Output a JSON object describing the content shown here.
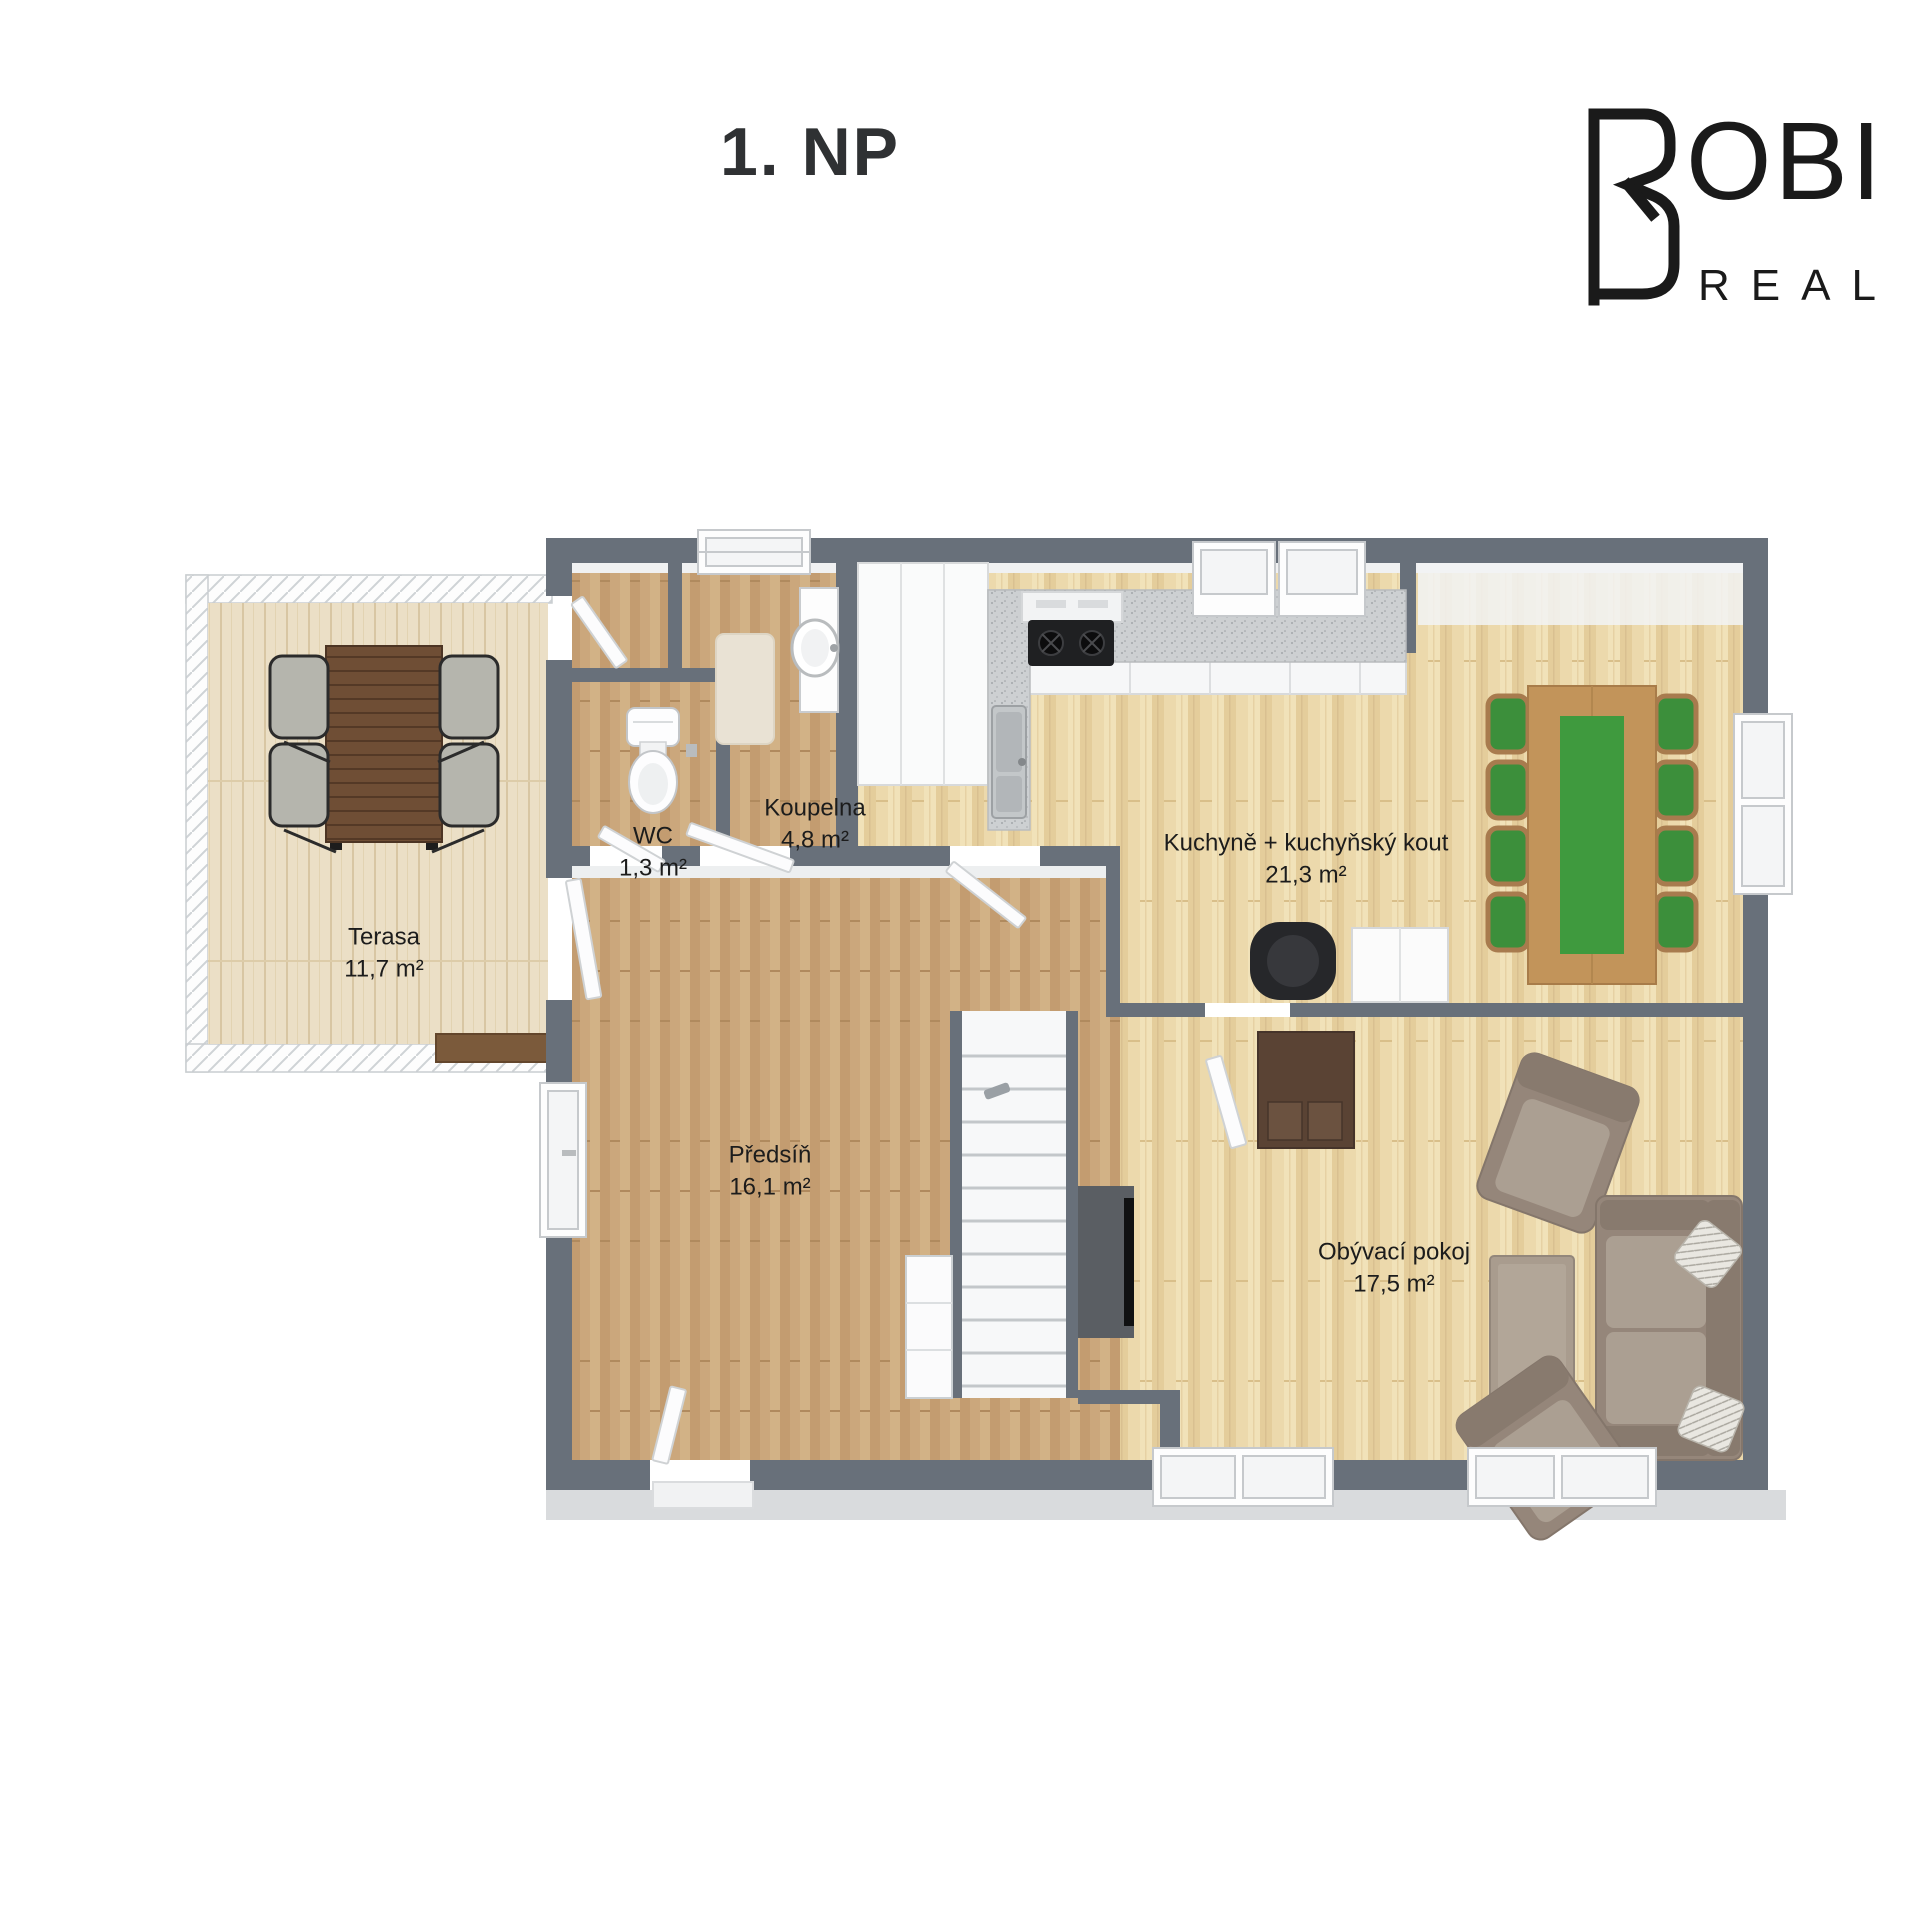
{
  "page": {
    "title": "1. NP",
    "background": "#ffffff"
  },
  "brand": {
    "name": "ROBI REAL",
    "mark": "stylized-RB-monogram",
    "top_text": "OBI",
    "bottom_text": "REAL",
    "color": "#1a1a1a"
  },
  "rooms": [
    {
      "id": "terasa",
      "name": "Terasa",
      "area": "11,7 m²",
      "label_x": 384,
      "label_y": 953
    },
    {
      "id": "wc",
      "name": "WC",
      "area": "1,3 m²",
      "label_x": 653,
      "label_y": 852
    },
    {
      "id": "koupelna",
      "name": "Koupelna",
      "area": "4,8 m²",
      "label_x": 815,
      "label_y": 824
    },
    {
      "id": "kuchyne",
      "name": "Kuchyně + kuchyňský kout",
      "area": "21,3 m²",
      "label_x": 1306,
      "label_y": 859
    },
    {
      "id": "predsin",
      "name": "Předsíň",
      "area": "16,1 m²",
      "label_x": 770,
      "label_y": 1171
    },
    {
      "id": "obyvaci",
      "name": "Obývací pokoj",
      "area": "17,5 m²",
      "label_x": 1394,
      "label_y": 1268
    }
  ],
  "colors": {
    "wall": "#68707a",
    "floor_light_wood": "#ecd9ac",
    "floor_medium_wood": "#cba77c",
    "terrace_deck": "#ebdfc6",
    "counter": "#cdd0d2",
    "accent_green": "#3f9a3e",
    "sofa_taupe": "#95867a",
    "dining_table_wood": "#c2945a",
    "dark_wood": "#5a4334",
    "label_text": "#1c1c1c"
  }
}
